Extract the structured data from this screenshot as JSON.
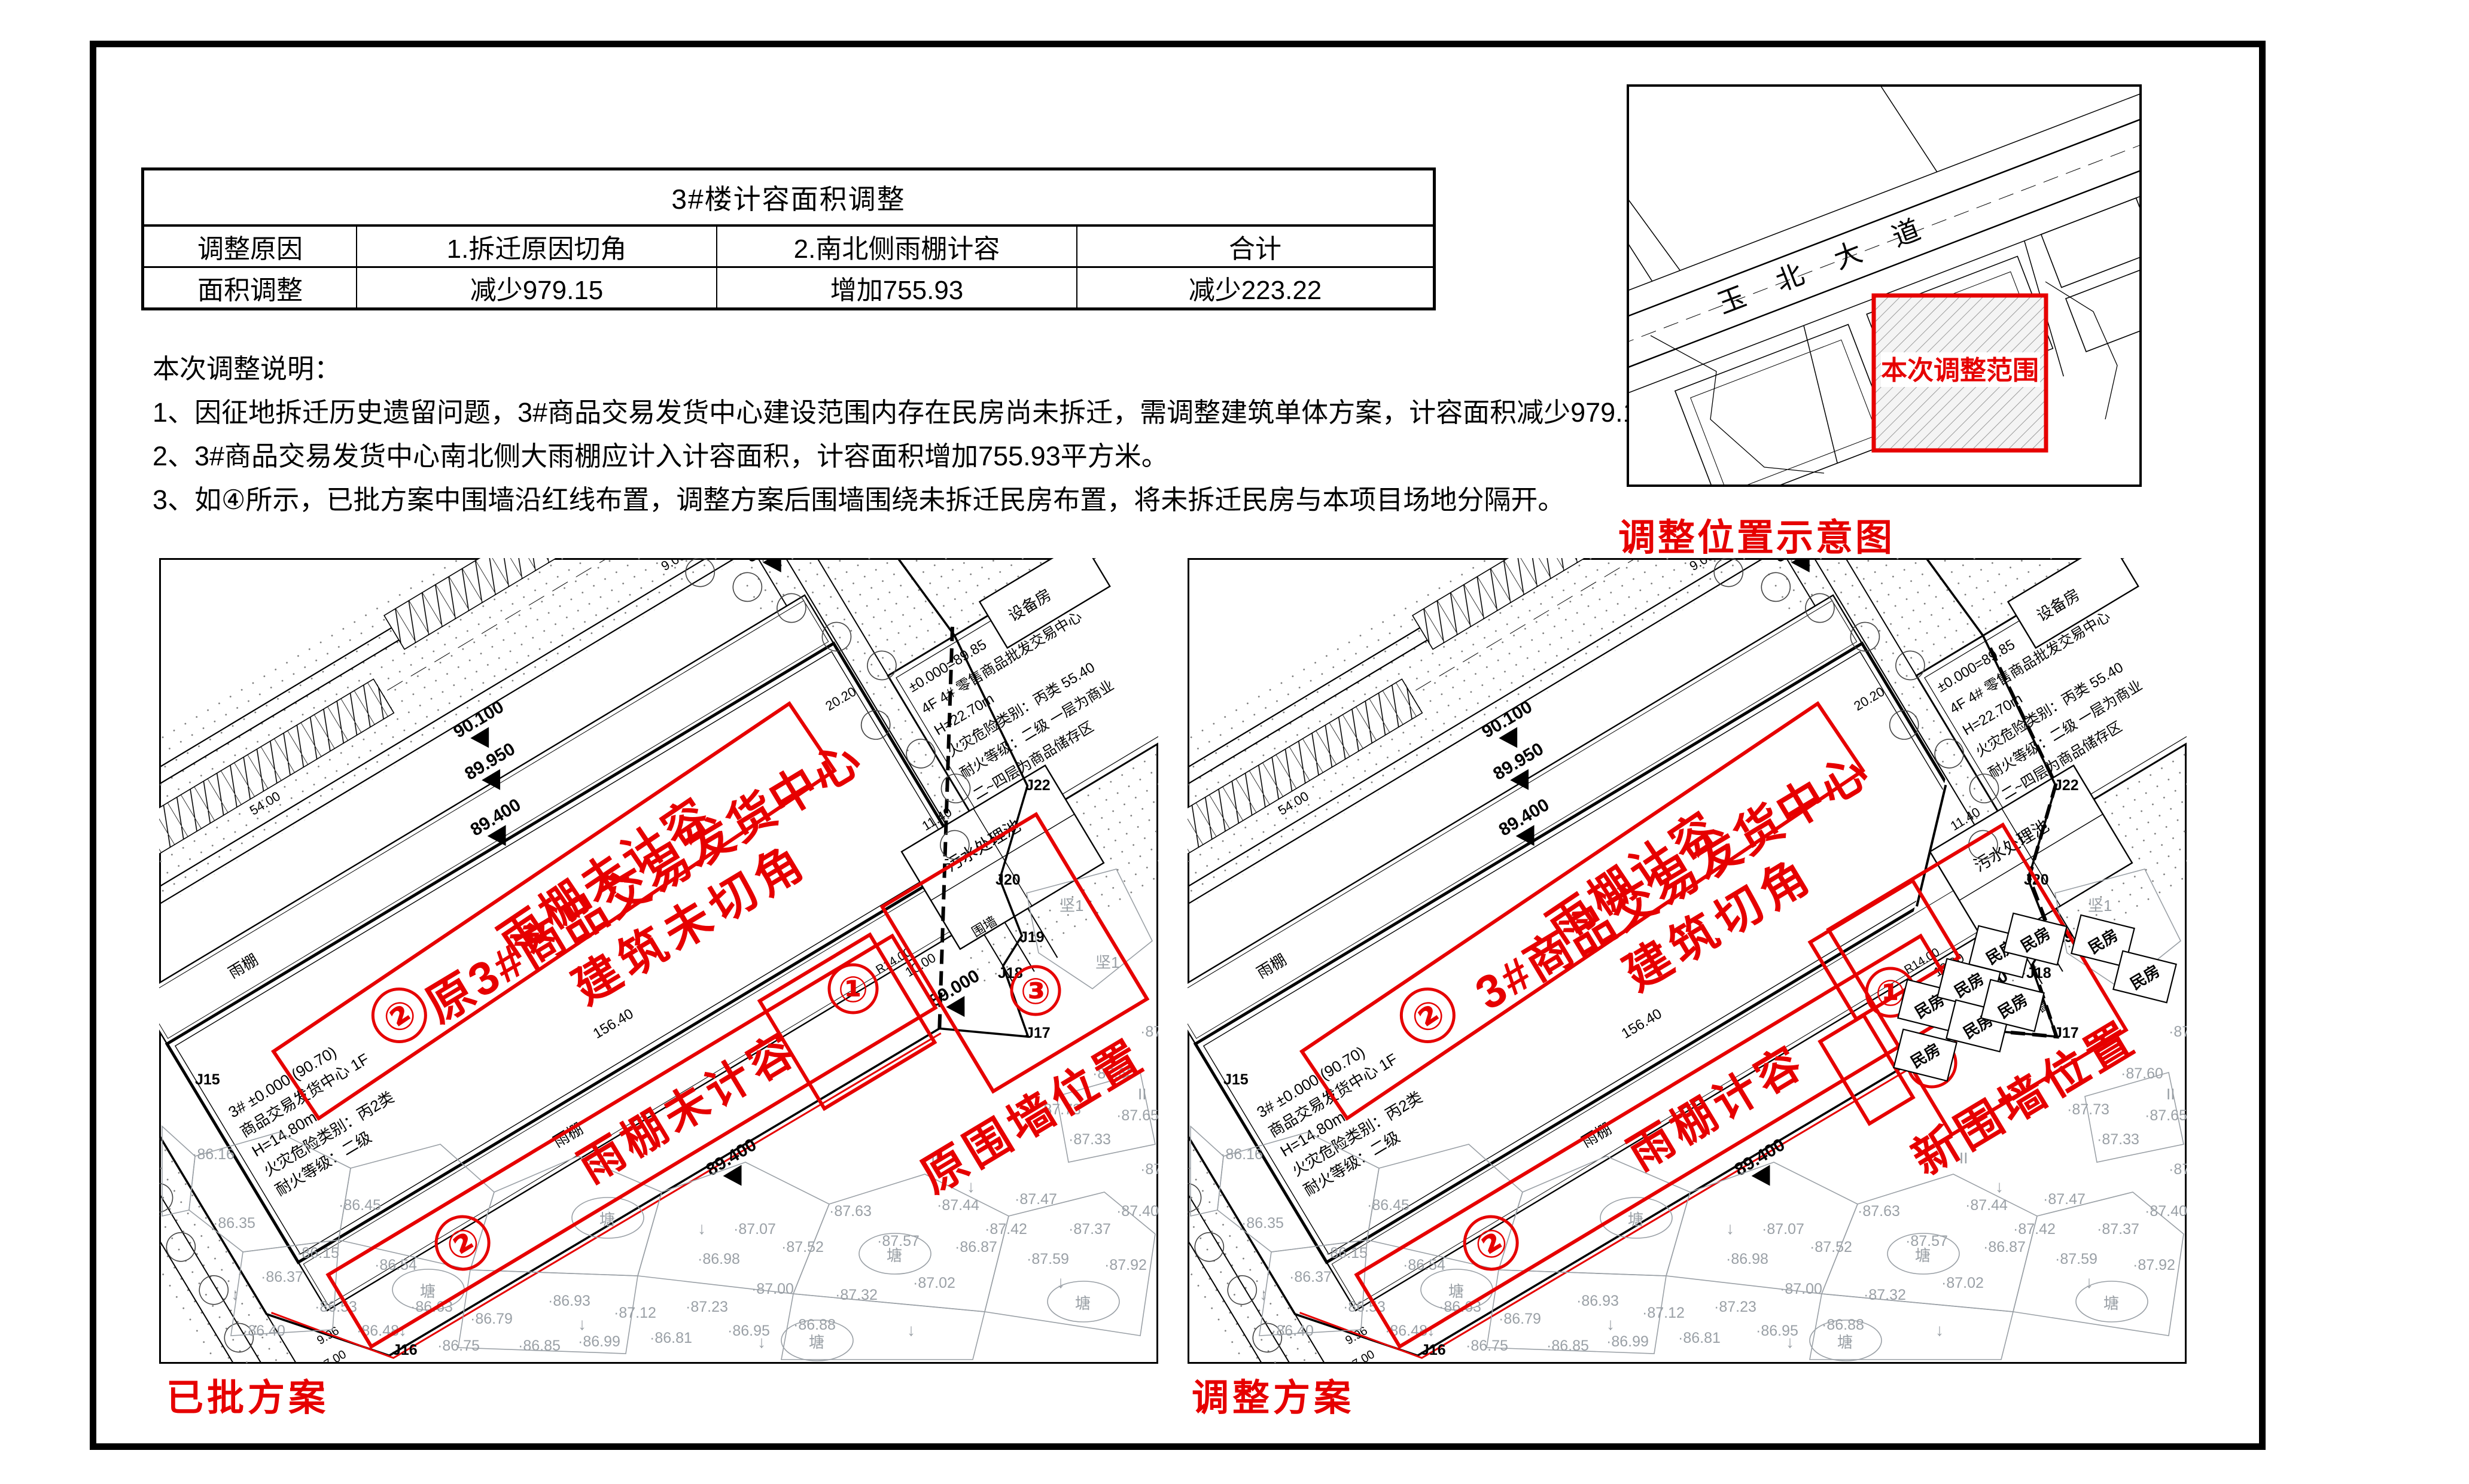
{
  "page": {
    "accent_red": "#e60000",
    "line_black": "#000000",
    "parcel_gray": "#9aa0a6"
  },
  "table": {
    "title": "3#楼计容面积调整",
    "rows": [
      {
        "cells": [
          "调整原因",
          "1.拆迁原因切角",
          "2.南北侧雨棚计容",
          "合计"
        ]
      },
      {
        "cells": [
          "面积调整",
          "减少979.15",
          "增加755.93",
          "减少223.22"
        ]
      }
    ]
  },
  "notes": {
    "heading": "本次调整说明：",
    "items": [
      "1、因征地拆迁历史遗留问题，3#商品交易发货中心建设范围内存在民房尚未拆迁，需调整建筑单体方案，计容面积减少979.15平方米。",
      "2、3#商品交易发货中心南北侧大雨棚应计入计容面积，计容面积增加755.93平方米。",
      "3、如④所示，已批方案中围墙沿红线布置，调整方案后围墙围绕未拆迁民房布置，将未拆迁民房与本项目场地分隔开。"
    ]
  },
  "map": {
    "road_name": "玉北大道",
    "scope_label": "本次调整范围",
    "caption": "调整位置示意图"
  },
  "shared_plan": {
    "bld3_lines": [
      "3#  ±0.000 (90.70)",
      "商品交易发货中心 1F",
      "H=14.80m",
      "火灾危险类别：丙2类",
      "耐火等级：二级"
    ],
    "bld4_lines": [
      "±0.000=89.85",
      "4F 4# 零售商品批发交易中心",
      "H=22.70m",
      "火灾危险类别：丙类  55.40",
      "耐火等级：二级 一层为商业",
      "二~四层为商品储存区"
    ],
    "canopy_label": "雨棚",
    "sewage_label": "污水处理池",
    "equipment_label": "设备房",
    "wall_label": "围墙",
    "minfang_label": "民房",
    "pond_label": "塘",
    "ground_label": "坚1",
    "roman_label": "II",
    "neighbor_lines": [
      "火灾危险类别：丙2类",
      "耐火等级：二级"
    ],
    "elevation_marks": [
      "90.100",
      "89.950",
      "89.400",
      "89.700",
      "89.000",
      "89.400",
      "89.700"
    ],
    "dims": [
      "156.40",
      "54.00",
      "9.00",
      "16.00",
      "20.20",
      "11.40",
      "25.91",
      "10.00",
      "R12.00",
      "R14.00",
      "7.00",
      "1.02",
      "9.96",
      "156.40"
    ],
    "j_points": [
      "J15",
      "J16",
      "J17",
      "J18",
      "J19",
      "J20",
      "J22"
    ],
    "spot_elevations": [
      "86.16",
      "86.35",
      "86.37",
      "86.40",
      "86.15",
      "86.53",
      "86.48",
      "86.54",
      "86.45",
      "86.63",
      "86.75",
      "86.79",
      "86.85",
      "86.93",
      "86.99",
      "87.12",
      "86.81",
      "87.23",
      "86.95",
      "87.00",
      "86.88",
      "87.32",
      "86.98",
      "87.07",
      "87.52",
      "87.63",
      "87.57",
      "87.02",
      "86.87",
      "87.44",
      "87.42",
      "87.59",
      "87.47",
      "87.37",
      "87.92",
      "87.40",
      "87.43",
      "87.33",
      "87.65",
      "87.60",
      "87.87",
      "87.73"
    ]
  },
  "plans": [
    {
      "caption": "已批方案",
      "canopy_num": "②",
      "canopy_note_top": "雨棚未计容",
      "canopy_note_bottom": "雨棚未计容",
      "building_note_line1": "原3#商品交易发货中心",
      "building_note_line2": "建筑未切角",
      "corner_num": "①",
      "wall_num": "③",
      "wall_note": "原围墙位置",
      "has_minfang": false
    },
    {
      "caption": "调整方案",
      "canopy_num": "②",
      "canopy_note_top": "雨棚计容",
      "canopy_note_bottom": "雨棚计容",
      "building_note_line1": "3#商品交易发货中心",
      "building_note_line2": "建筑切角",
      "corner_num": "①",
      "wall_num": "③",
      "wall_note": "新围墙位置",
      "has_minfang": true
    }
  ]
}
